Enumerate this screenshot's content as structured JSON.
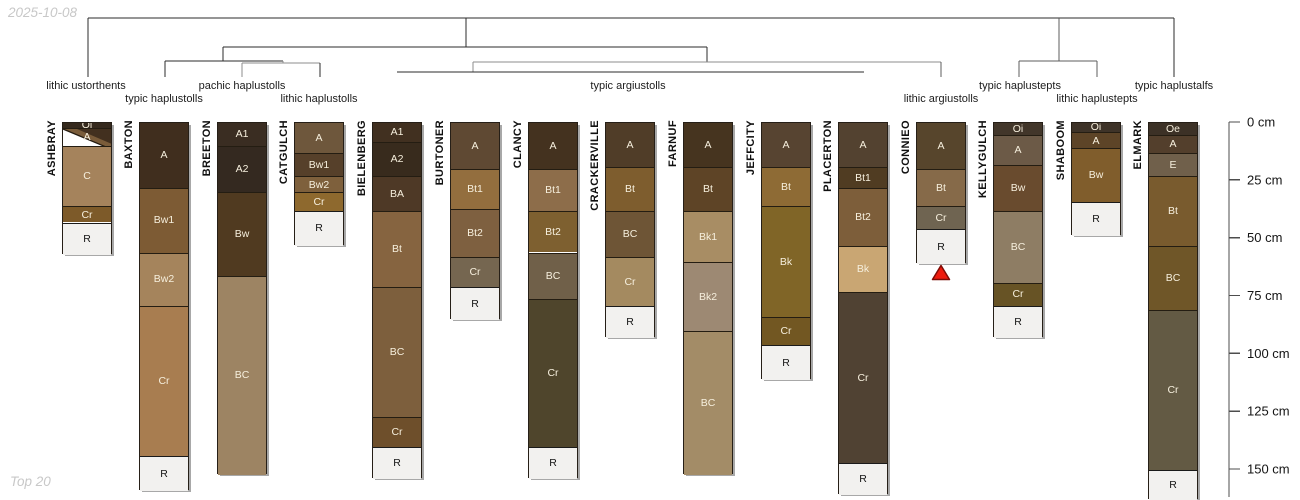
{
  "meta": {
    "date_label": "2025-10-08",
    "footer_label": "Top 20",
    "background": "#ffffff",
    "marker_color": "#ee1b0e",
    "marker_border": "#7e0b05"
  },
  "chart_data": {
    "type": "other",
    "description": "Soil profile sketches of 15 pedons grouped by a taxonomic dendrogram (subgroup level), with horizon designations and a depth axis in cm",
    "layout": {
      "column_width": 50,
      "top_y": 122,
      "px_per_cm": 2.313,
      "grid": false
    },
    "depth_axis": {
      "unit": "cm",
      "ticks": [
        0,
        25,
        50,
        75,
        100,
        125,
        150
      ],
      "tick_suffix": " cm",
      "x": 1229,
      "axis_bottom_y": 497
    },
    "taxa_labels": [
      {
        "name": "lithic ustorthents",
        "x": 86,
        "row": 1
      },
      {
        "name": "typic haplustolls",
        "x": 164,
        "row": 2
      },
      {
        "name": "pachic haplustolls",
        "x": 242,
        "row": 1
      },
      {
        "name": "lithic haplustolls",
        "x": 319,
        "row": 2
      },
      {
        "name": "typic argiustolls",
        "x": 628,
        "row": 1
      },
      {
        "name": "lithic argiustolls",
        "x": 941,
        "row": 2
      },
      {
        "name": "typic haplustepts",
        "x": 1020,
        "row": 1
      },
      {
        "name": "lithic haplustepts",
        "x": 1097,
        "row": 2
      },
      {
        "name": "typic haplustalfs",
        "x": 1174,
        "row": 1
      }
    ],
    "dendrogram_segments": [
      {
        "x1": 88,
        "y1": 18,
        "x2": 1174,
        "y2": 18,
        "c": "dark"
      },
      {
        "x1": 88,
        "y1": 18,
        "x2": 88,
        "y2": 77,
        "c": "dark"
      },
      {
        "x1": 466,
        "y1": 18,
        "x2": 466,
        "y2": 47,
        "c": "dark"
      },
      {
        "x1": 1059,
        "y1": 18,
        "x2": 1059,
        "y2": 61,
        "c": "mid"
      },
      {
        "x1": 1174,
        "y1": 18,
        "x2": 1174,
        "y2": 77,
        "c": "dark"
      },
      {
        "x1": 223,
        "y1": 47,
        "x2": 707,
        "y2": 47,
        "c": "dark"
      },
      {
        "x1": 223,
        "y1": 47,
        "x2": 223,
        "y2": 61,
        "c": "dark"
      },
      {
        "x1": 707,
        "y1": 47,
        "x2": 707,
        "y2": 62,
        "c": "dark"
      },
      {
        "x1": 165,
        "y1": 61,
        "x2": 283,
        "y2": 61,
        "c": "dark"
      },
      {
        "x1": 165,
        "y1": 61,
        "x2": 165,
        "y2": 77,
        "c": "dark"
      },
      {
        "x1": 283,
        "y1": 61,
        "x2": 283,
        "y2": 63,
        "c": "grey"
      },
      {
        "x1": 242,
        "y1": 63,
        "x2": 320,
        "y2": 63,
        "c": "grey"
      },
      {
        "x1": 242,
        "y1": 63,
        "x2": 242,
        "y2": 77,
        "c": "grey"
      },
      {
        "x1": 320,
        "y1": 63,
        "x2": 320,
        "y2": 77,
        "c": "dark"
      },
      {
        "x1": 473,
        "y1": 62,
        "x2": 941,
        "y2": 62,
        "c": "grey"
      },
      {
        "x1": 473,
        "y1": 62,
        "x2": 473,
        "y2": 72,
        "c": "grey"
      },
      {
        "x1": 397,
        "y1": 72,
        "x2": 864,
        "y2": 72,
        "c": "dark"
      },
      {
        "x1": 941,
        "y1": 62,
        "x2": 941,
        "y2": 77,
        "c": "mid"
      },
      {
        "x1": 1019,
        "y1": 61,
        "x2": 1097,
        "y2": 61,
        "c": "mid"
      },
      {
        "x1": 1019,
        "y1": 61,
        "x2": 1019,
        "y2": 77,
        "c": "mid"
      },
      {
        "x1": 1097,
        "y1": 61,
        "x2": 1097,
        "y2": 77,
        "c": "mid"
      }
    ],
    "profiles": [
      {
        "name": "ASHBRAY",
        "x": 62,
        "horizons": [
          {
            "label": "Oi",
            "t": 0,
            "b": 2,
            "color": "#35291d"
          },
          {
            "label": "A",
            "t": 2,
            "b": 10,
            "color": "#7a5c3a",
            "wedge": true
          },
          {
            "label": "C",
            "t": 10,
            "b": 36,
            "color": "#a5835c"
          },
          {
            "label": "Cr",
            "t": 36,
            "b": 43,
            "color": "#7d5a29"
          },
          {
            "label": "R",
            "t": 43,
            "b": 57,
            "rock": true
          }
        ]
      },
      {
        "name": "BAXTON",
        "x": 139,
        "horizons": [
          {
            "label": "A",
            "t": 0,
            "b": 28,
            "color": "#402e1e"
          },
          {
            "label": "Bw1",
            "t": 28,
            "b": 56,
            "color": "#7d5b34"
          },
          {
            "label": "Bw2",
            "t": 56,
            "b": 79,
            "color": "#a5845c"
          },
          {
            "label": "Cr",
            "t": 79,
            "b": 144,
            "color": "#a87d50"
          },
          {
            "label": "R",
            "t": 144,
            "b": 159,
            "rock": true
          }
        ]
      },
      {
        "name": "BREETON",
        "x": 217,
        "horizons": [
          {
            "label": "A1",
            "t": 0,
            "b": 10,
            "color": "#3a2d22"
          },
          {
            "label": "A2",
            "t": 10,
            "b": 30,
            "color": "#342920"
          },
          {
            "label": "Bw",
            "t": 30,
            "b": 66,
            "color": "#503a20"
          },
          {
            "label": "BC",
            "t": 66,
            "b": 152,
            "color": "#9d8463"
          }
        ]
      },
      {
        "name": "CATGULCH",
        "x": 294,
        "horizons": [
          {
            "label": "A",
            "t": 0,
            "b": 13,
            "color": "#6e573c"
          },
          {
            "label": "Bw1",
            "t": 13,
            "b": 23,
            "color": "#56402a"
          },
          {
            "label": "Bw2",
            "t": 23,
            "b": 30,
            "color": "#7e603c"
          },
          {
            "label": "Cr",
            "t": 30,
            "b": 38,
            "color": "#8e692e"
          },
          {
            "label": "R",
            "t": 38,
            "b": 53,
            "rock": true
          }
        ]
      },
      {
        "name": "BIELENBERG",
        "x": 372,
        "horizons": [
          {
            "label": "A1",
            "t": 0,
            "b": 8,
            "color": "#413020"
          },
          {
            "label": "A2",
            "t": 8,
            "b": 23,
            "color": "#382b1d"
          },
          {
            "label": "BA",
            "t": 23,
            "b": 38,
            "color": "#4e3926"
          },
          {
            "label": "Bt",
            "t": 38,
            "b": 71,
            "color": "#866440"
          },
          {
            "label": "BC",
            "t": 71,
            "b": 127,
            "color": "#7d5f3d"
          },
          {
            "label": "Cr",
            "t": 127,
            "b": 140,
            "color": "#6e4f2b"
          },
          {
            "label": "R",
            "t": 140,
            "b": 154,
            "rock": true
          }
        ]
      },
      {
        "name": "BURTONER",
        "x": 450,
        "horizons": [
          {
            "label": "A",
            "t": 0,
            "b": 20,
            "color": "#5f4933"
          },
          {
            "label": "Bt1",
            "t": 20,
            "b": 37,
            "color": "#936e3e"
          },
          {
            "label": "Bt2",
            "t": 37,
            "b": 58,
            "color": "#7e6040"
          },
          {
            "label": "Cr",
            "t": 58,
            "b": 71,
            "color": "#756650"
          },
          {
            "label": "R",
            "t": 71,
            "b": 85,
            "rock": true
          }
        ]
      },
      {
        "name": "CLANCY",
        "x": 528,
        "horizons": [
          {
            "label": "A",
            "t": 0,
            "b": 20,
            "color": "#44321f"
          },
          {
            "label": "Bt1",
            "t": 20,
            "b": 38,
            "color": "#8d6d4a"
          },
          {
            "label": "Bt2",
            "t": 38,
            "b": 56,
            "color": "#7e6030"
          },
          {
            "label": "BC",
            "t": 56,
            "b": 76,
            "color": "#706049"
          },
          {
            "label": "Cr",
            "t": 76,
            "b": 140,
            "color": "#4f452c"
          },
          {
            "label": "R",
            "t": 140,
            "b": 154,
            "rock": true
          }
        ]
      },
      {
        "name": "CRACKERVILLE",
        "x": 605,
        "horizons": [
          {
            "label": "A",
            "t": 0,
            "b": 19,
            "color": "#503d28"
          },
          {
            "label": "Bt",
            "t": 19,
            "b": 38,
            "color": "#7e5d2e"
          },
          {
            "label": "BC",
            "t": 38,
            "b": 58,
            "color": "#6e5536"
          },
          {
            "label": "Cr",
            "t": 58,
            "b": 79,
            "color": "#a48a60"
          },
          {
            "label": "R",
            "t": 79,
            "b": 93,
            "rock": true
          }
        ]
      },
      {
        "name": "FARNUF",
        "x": 683,
        "horizons": [
          {
            "label": "A",
            "t": 0,
            "b": 19,
            "color": "#46341f"
          },
          {
            "label": "Bt",
            "t": 19,
            "b": 38,
            "color": "#5e4426"
          },
          {
            "label": "Bk1",
            "t": 38,
            "b": 60,
            "color": "#a88d64"
          },
          {
            "label": "Bk2",
            "t": 60,
            "b": 90,
            "color": "#9d8973"
          },
          {
            "label": "BC",
            "t": 90,
            "b": 152,
            "color": "#a38c67"
          }
        ]
      },
      {
        "name": "JEFFCITY",
        "x": 761,
        "horizons": [
          {
            "label": "A",
            "t": 0,
            "b": 19,
            "color": "#574431"
          },
          {
            "label": "Bt",
            "t": 19,
            "b": 36,
            "color": "#8e6b35"
          },
          {
            "label": "Bk",
            "t": 36,
            "b": 84,
            "color": "#806527"
          },
          {
            "label": "Cr",
            "t": 84,
            "b": 96,
            "color": "#725722"
          },
          {
            "label": "R",
            "t": 96,
            "b": 111,
            "rock": true
          }
        ]
      },
      {
        "name": "PLACERTON",
        "x": 838,
        "horizons": [
          {
            "label": "A",
            "t": 0,
            "b": 19,
            "color": "#534230"
          },
          {
            "label": "Bt1",
            "t": 19,
            "b": 28,
            "color": "#503c22"
          },
          {
            "label": "Bt2",
            "t": 28,
            "b": 53,
            "color": "#7d5e3a"
          },
          {
            "label": "Bk",
            "t": 53,
            "b": 73,
            "color": "#c9a673"
          },
          {
            "label": "Cr",
            "t": 73,
            "b": 147,
            "color": "#504233"
          },
          {
            "label": "R",
            "t": 147,
            "b": 161,
            "rock": true
          }
        ]
      },
      {
        "name": "CONNIEO",
        "x": 916,
        "marker": true,
        "horizons": [
          {
            "label": "A",
            "t": 0,
            "b": 20,
            "color": "#57452c"
          },
          {
            "label": "Bt",
            "t": 20,
            "b": 36,
            "color": "#866a49"
          },
          {
            "label": "Cr",
            "t": 36,
            "b": 46,
            "color": "#6f6451"
          },
          {
            "label": "R",
            "t": 46,
            "b": 61,
            "rock": true
          }
        ]
      },
      {
        "name": "KELLYGULCH",
        "x": 993,
        "horizons": [
          {
            "label": "Oi",
            "t": 0,
            "b": 5,
            "color": "#42362a"
          },
          {
            "label": "A",
            "t": 5,
            "b": 18,
            "color": "#6c5a47"
          },
          {
            "label": "Bw",
            "t": 18,
            "b": 38,
            "color": "#694b2e"
          },
          {
            "label": "BC",
            "t": 38,
            "b": 69,
            "color": "#8e7d64"
          },
          {
            "label": "Cr",
            "t": 69,
            "b": 79,
            "color": "#675325"
          },
          {
            "label": "R",
            "t": 79,
            "b": 93,
            "rock": true
          }
        ]
      },
      {
        "name": "SHABOOM",
        "x": 1071,
        "horizons": [
          {
            "label": "Oi",
            "t": 0,
            "b": 4,
            "color": "#3e3328"
          },
          {
            "label": "A",
            "t": 4,
            "b": 11,
            "color": "#5d4427"
          },
          {
            "label": "Bw",
            "t": 11,
            "b": 34,
            "color": "#805d2c"
          },
          {
            "label": "R",
            "t": 34,
            "b": 49,
            "rock": true
          }
        ]
      },
      {
        "name": "ELMARK",
        "x": 1148,
        "horizons": [
          {
            "label": "Oe",
            "t": 0,
            "b": 5,
            "color": "#3c3126"
          },
          {
            "label": "A",
            "t": 5,
            "b": 13,
            "color": "#533f2c"
          },
          {
            "label": "E",
            "t": 13,
            "b": 23,
            "color": "#70604b"
          },
          {
            "label": "Bt",
            "t": 23,
            "b": 53,
            "color": "#795b2e"
          },
          {
            "label": "BC",
            "t": 53,
            "b": 81,
            "color": "#6f5628"
          },
          {
            "label": "Cr",
            "t": 81,
            "b": 150,
            "color": "#635a44"
          },
          {
            "label": "R",
            "t": 150,
            "b": 163,
            "rock": true
          }
        ]
      }
    ],
    "marker": {
      "profile": "CONNIEO",
      "shape": "triangle-up",
      "x": 941,
      "y": 273
    }
  }
}
